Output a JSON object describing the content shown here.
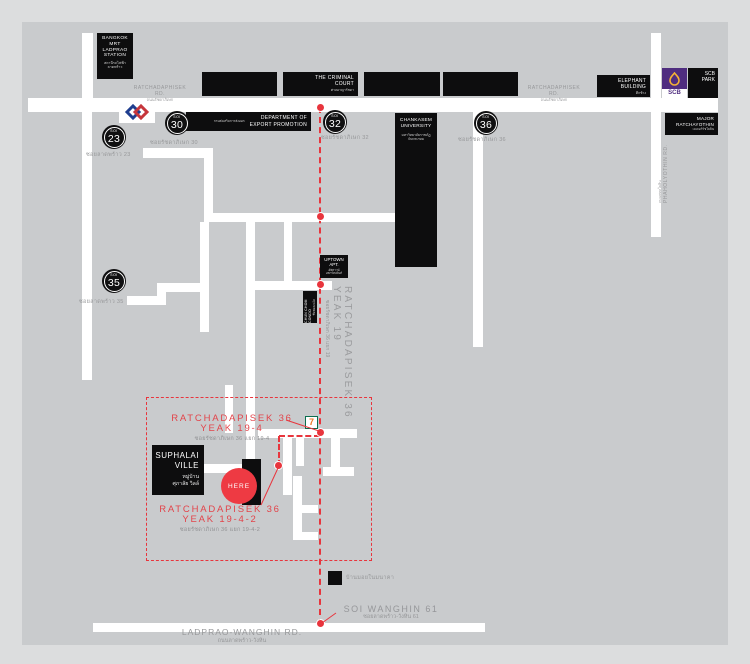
{
  "colors": {
    "route_red": "#e8353d",
    "label_red": "#e2444a",
    "building_black": "#0d0d0e",
    "map_gray": "#c9cbcd",
    "frame_gray": "#dcddde",
    "label_gray": "#97989a",
    "scb_purple": "#4f2d7f",
    "scb_gold": "#f5b335",
    "mrt_blue": "#1f3e8f",
    "mrt_red": "#c6363c",
    "seven_green": "#0a6e4e",
    "seven_orange": "#ee7623"
  },
  "roads": {
    "ratchadaphisek": {
      "en": "RATCHADAPHISEK RD.",
      "th": "ถนนรัชดาภิเษก"
    },
    "phaholyothin": {
      "en": "PHAHOLYOTHIN RD.",
      "th": "ถนนพหลโยธิน"
    },
    "ladprao_wanghin": {
      "en": "LADPRAO-WANGHIN RD.",
      "th": "ถนนลาดพร้าว-วังหิน"
    },
    "soi_wanghin_61": {
      "en": "SOI WANGHIN 61",
      "th": "ซอยลาดพร้าว-วังหิน 61"
    },
    "yeak_19": {
      "en": "RATCHADAPISEK 36 YEAK 19",
      "th": "ซอยรัชดาภิเษก 36 แยก 19"
    },
    "yeak_19_4": {
      "en": "RATCHADAPISEK 36 YEAK 19-4",
      "th": "ซอยรัชดาภิเษก 36 แยก 19-4"
    },
    "yeak_19_4_2": {
      "en": "RATCHADAPISEK 36 YEAK 19-4-2",
      "th": "ซอยรัชดาภิเษก 36 แยก 19-4-2"
    }
  },
  "sois": {
    "s23": {
      "prefix": "SOI",
      "number": "23",
      "label_th": "ซอยลาดพร้าว 23"
    },
    "s30": {
      "prefix": "SOI",
      "number": "30",
      "label_th": "ซอยรัชดาภิเษก 30"
    },
    "s32": {
      "prefix": "SOI",
      "number": "32",
      "label_th": "ซอยรัชดาภิเษก 32"
    },
    "s35": {
      "prefix": "SOI",
      "number": "35",
      "label_th": "ซอยลาดพร้าว 35"
    },
    "s36": {
      "prefix": "SOI",
      "number": "36",
      "label_th": "ซอยรัชดาภิเษก 36"
    }
  },
  "places": {
    "mrt_station": {
      "en": "BANGKOK\nMRT\nLADPRAO\nSTATION",
      "th": "สถานีรถไฟฟ้า\nลาดพร้าว"
    },
    "criminal_court": {
      "en": "THE CRIMINAL\nCOURT",
      "th": "ศาลอาญารัชดา"
    },
    "export_dept": {
      "en": "DEPARTMENT OF\nEXPORT PROMOTION",
      "th": "กรมส่งเสริมการส่งออก"
    },
    "chankasem": {
      "en": "CHANKASEM\nUNIVERSITY",
      "th": "มหาวิทยาลัยราชภัฏ\nจันทรเกษม"
    },
    "elephant": {
      "en": "ELEPHANT\nBUILDING",
      "th": "ตึกช้าง"
    },
    "scb_park": {
      "en": "SCB\nPARK",
      "logo_text": "SCB"
    },
    "major_ratchayothin": {
      "en": "MAJOR\nRATCHAYOTHIN",
      "th": "เมเจอร์รัชโยธิน"
    },
    "uptown": {
      "en": "UPTOWN\nAPT.",
      "th": "อัพทาวน์\nอพาร์ทเม้นท์"
    },
    "chunchom": {
      "en": "CHUN CHOM CONDO",
      "th": "ชื่นชมคอนโด"
    },
    "suphalai": {
      "en": "SUPHALAI\nVILLE",
      "th": "หมู่บ้าน\nศุภาลัย วิลล์"
    },
    "wanghin_house": {
      "th": "บ้านมอยในมนาคา"
    },
    "seven_eleven": {
      "glyph": "7"
    }
  },
  "marker": {
    "here": "HERE"
  }
}
